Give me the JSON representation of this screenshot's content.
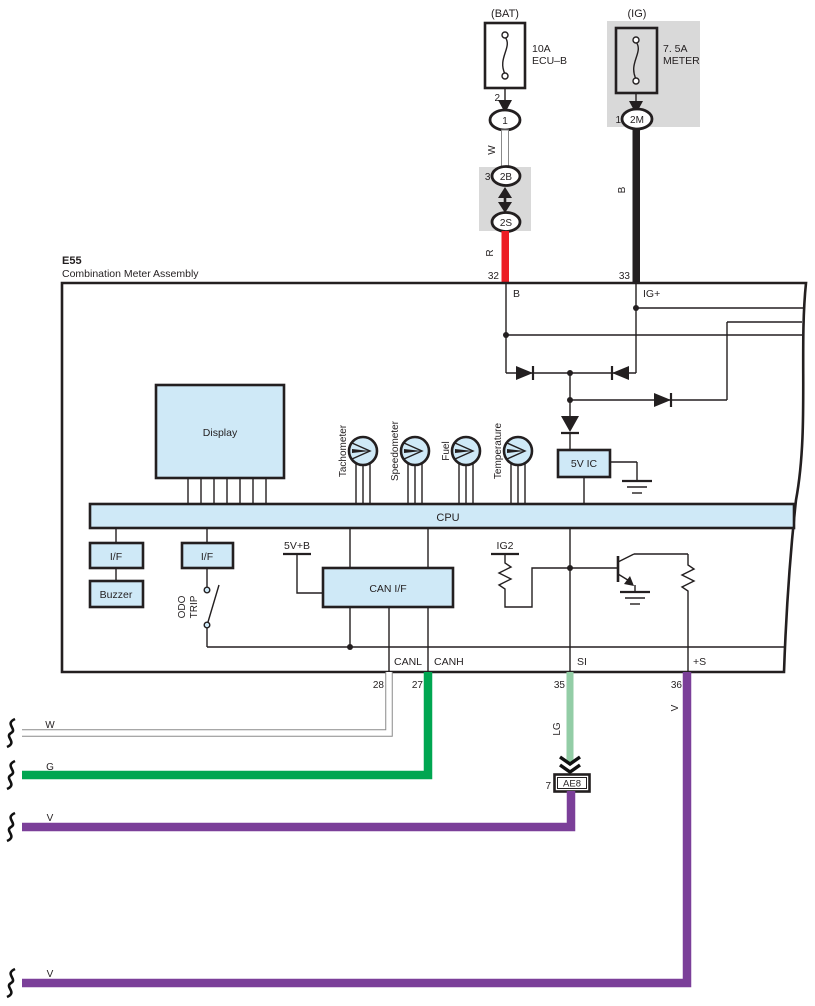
{
  "colors": {
    "assembly_fill": "#cfe9f7",
    "gray": "#d9d9d9",
    "red": "#ec1c24",
    "green": "#00a651",
    "light_green": "#93cda6",
    "purple": "#7b3f99",
    "wire_black": "#231f20",
    "line": "#231f20"
  },
  "top": {
    "bat": {
      "source": "(BAT)",
      "rating": "10A",
      "name": "ECU–B",
      "pin": "2",
      "connector": "1",
      "wire": "W"
    },
    "junction": {
      "pin_in": "30",
      "connector_in": "2B",
      "pin_out": "2",
      "connector_out": "2S",
      "wire": "R"
    },
    "ig": {
      "source": "(IG)",
      "rating": "7. 5A",
      "name": "METER",
      "pin": "1",
      "connector": "2M",
      "wire": "B"
    }
  },
  "assembly": {
    "code": "E55",
    "name": "Combination Meter Assembly",
    "pin32": {
      "num": "32",
      "label": "B"
    },
    "pin33": {
      "num": "33",
      "label": "IG+"
    },
    "pin28": {
      "num": "28",
      "label": "CANL"
    },
    "pin27": {
      "num": "27",
      "label": "CANH"
    },
    "pin35": {
      "num": "35",
      "label": "SI"
    },
    "pin36": {
      "num": "36",
      "label": "+S"
    },
    "display": "Display",
    "gauges": {
      "tachometer": "Tachometer",
      "speedometer": "Speedometer",
      "fuel": "Fuel",
      "temperature": "Temperature"
    },
    "ic": "5V IC",
    "cpu": "CPU",
    "interface": "I/F",
    "buzzer": "Buzzer",
    "odo": "ODO",
    "trip": "TRIP",
    "rail": "5V+B",
    "can_if": "CAN I/F",
    "ig2": "IG2"
  },
  "bottom": {
    "wire_w": "W",
    "wire_g": "G",
    "wire_lg": "LG",
    "wire_v": "V",
    "wire_v36": "V",
    "wire_v_bottom": "V",
    "ae8": {
      "pin": "7",
      "label": "AE8"
    }
  }
}
